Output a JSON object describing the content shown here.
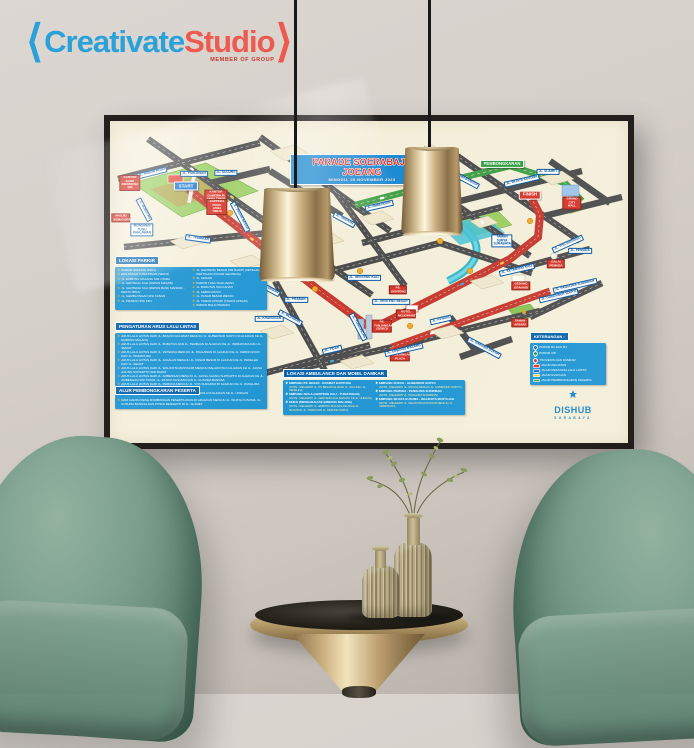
{
  "brand": {
    "bracket_left": "⟨",
    "name_blue": "Creativate",
    "name_red": "Studio",
    "bracket_right": "⟩",
    "tagline": "MEMBER OF GROUP"
  },
  "poster": {
    "title": "PARADE SOERABAJA JOEANG",
    "subtitle": "MINGGU, 05 NOVEMBER 2023",
    "panels": {
      "parking": {
        "header": "LOKASI PARKIR",
        "col1": [
          "PARKIR GEDUNG SIOLA",
          "EKS PASAR TUNJUNGAN (SEIKO)",
          "JL. EMBONG MALANG SISI UTARA",
          "JL. GENTENG KALI (DEPAN MASJID)",
          "JL. GENTENG KALI (DEPAN BANK MANDIRI - RESTO BINA)",
          "JL. GEMBLONGAN SISI KANAN",
          "JL. PRABAN SISI KIRI"
        ],
        "col2": [
          "JL. GENTENG BESAR SISI BARAT (SETELAH PERTIGAAN PASAR GENTENG)",
          "JL. KENARI",
          "PARKIR TUGU PAHLAWAN",
          "JL. BUBUTAN SISI KANAN",
          "JL. KEBON ROJO",
          "JL. PASAR BESAR WETAN",
          "JL. TAMAN APSARI (TAMAN APSARI)",
          "PARKIR BALAI PEMUDA"
        ]
      },
      "traffic": {
        "header": "PENGATURAN ARUS LALU LINTAS",
        "items": [
          "ARUS LALU LINTAS DARI JL. BASUKI RACHMAT MENUJU JL. GUBERNUR SURYO DI ALIHKAN KE JL. EMBONG MALANG",
          "ARUS LALU LINTAS DARI JL. BUBUTAN DAN JL. TEMBAAN DI ALIHKAN KE JL. INDRAPURA DAN JL. SEMUT",
          "ARUS LALU LINTAS DARI JL. VETERAN MENUJU JL. PAHLAWAN DI ALIHKAN KE JL. KEBON ROJO DAN JL. INDRAPURA",
          "ARUS LALU LINTAS DARI JL. JAGALAN MENUJU JL. PASAR BESAR DI ALIHKAN KE JL. PENELEH DAN JL. SEMUT",
          "ARUS LALU LINTAS DARI JL. WALIKOTA MUSTAJAB MENUJU BALAIKOTA DI ALIHKAN KE JL. JAKSA AGUNG SUPRAPTO SISI BARAT",
          "ARUS LALU LINTAS DARI JL. AMBENGAN MENUJU JL. JAKSA AGUNG SUPRAPTO DI ALIHKAN KE JL. AMBENGAN SISI TIMUR, JL. WIJAYA KUSUMA DAN JL. KUSUMA BANGSA",
          "ARUS LALU LINTAS DARI JL. PEMUDA MENUJU JL. YOS SUDARSO DI ALIHKAN KE JL. PANGLIMA SUDIRMAN",
          "ARUS LALU LINTAS DARI JL. GENTENG KALI MENUJU SIOLA DI ALIHKAN KE JL. UNDAAN"
        ]
      },
      "unloading": {
        "header": "ALUR PEMBONGKARAN PESERTA",
        "items": [
          "DARI GARIS FINISH ROMBONGAN PESERTA AKAN DI ARAHKAN MENUJU JL. WIJAYA KUSUMA, JL. KUSUMA BANGSA DAN POSISI BERHENTI DI JL. SLAMET"
        ]
      },
      "ambulance": {
        "header": "LOKASI AMBULANCE DAN MOBIL DAMKAR",
        "col1": [
          {
            "name": "SIMPANG PS. BESAR - KRAMAT GANTUNG",
            "route": "(RUTE : MELEWATI JL. PS BESAR KE ARAH JL. SULUNG / JL. PENELEH)"
          },
          {
            "name": "SIMPANG SIOLA (GENTENG KALI - TUNJUNGAN)",
            "route": "(RUTE : MELEWATI JL. GENTENG KALI MENUJU KE JL. UNDAAN)"
          },
          {
            "name": "SEIKO (MENGARAH KE EMBONG MALANG)",
            "route": "(RUTE : MELEWATI JL. EMBONG MALANG KE ARAH JL. BLAURAN, JL. TIDAR DAN JL. KEDUNG DORO)"
          }
        ],
        "col2": [
          {
            "name": "SIMPANG DUKUH - GUBERNUR SURYO",
            "route": "(RUTE : MELEWATI JL. DUKUH MENUJU JL. GUBERNUR SURYO)"
          },
          {
            "name": "SIMPANG PEMUDA - PANGLIMA SUDIRMAN",
            "route": "(RUTE : MELEWATI JL. PANGLIMA SUDIRMAN)"
          },
          {
            "name": "SIMPANG WIJAYA KUSUMA - WALIKOTA MUSTAJAB",
            "route": "(RUTE : MELEWATI JL. WALIKOTA MUSTAJAB MENUJU JL. AMBENGAN)"
          }
        ]
      },
      "legend": {
        "header": "KETERANGAN :",
        "items": [
          {
            "icon": "pin-blue",
            "label": "PARKIR R2 DAN R4"
          },
          {
            "icon": "pin-green",
            "label": "PARKIR VIP"
          },
          {
            "icon": "pin-red",
            "label": "TIM MEDIS DAN DAMKAR"
          },
          {
            "icon": "line-red",
            "label": "JALUR KEGIATAN"
          },
          {
            "icon": "line-blue",
            "label": "JALUR REKAYASA LALU LINTAS"
          },
          {
            "icon": "line-yellow",
            "label": "JALUR EVAKUASI"
          },
          {
            "icon": "line-green",
            "label": "JALUR PEMBONGKARAN PESERTA"
          }
        ]
      },
      "agency": {
        "name": "DISHUB",
        "city": "SURABAYA"
      }
    },
    "map_labels": {
      "start": "START",
      "finish": "FINISH",
      "pembongkaran": "PEMBONGKARAN",
      "bank_indonesia": "KANTOR BANK INDONESIA (BI)",
      "kantor_gubernur": "KANTOR GUBERNUR JAWA TIMUR",
      "bappeda": "BAPPEDA PROV. JAWA TIMUR",
      "masjid_kemayoran": "MASJID KEMAYORAN",
      "monumen": "MONUMEN TUGU PAHLAWAN",
      "gedung_siola": "GEDUNG SIOLA",
      "ps_genteng": "PS. GENTENG",
      "hotel_mojopahit": "HOTEL MOJOPAHIT",
      "gedung_grahadi": "GEDUNG GRAHADI",
      "balai_pemuda": "BALAI PEMUDA",
      "grand_city": "GRAND CITY MALL",
      "tunjungan_plaza": "TUNJUNGAN PLAZA",
      "ps_tunjungan": "PS. TUNJUNGAN (SEIKO)",
      "taman_apsari": "TAMAN APSARI",
      "taman_surya": "TAMAN SURYA SURABAYA",
      "jl_kebon_rojo": "JL. KEBON ROJO",
      "jl_pahlawan": "JL. PAHLAWAN",
      "jl_sulung": "JL. SULUNG",
      "jl_bubutan": "JL. BUBUTAN",
      "jl_tembaan": "JL. TEMBAAN",
      "jl_pasar_besar": "JL. PASAR BESAR",
      "jl_gemblongan": "JL. GEMBLONGAN",
      "jl_kranggan": "JL. KRANGGAN",
      "jl_praban": "JL. PRABAN",
      "jl_blauran": "JL. BLAURAN",
      "jl_tunjungan": "JL. TUNJUNGAN",
      "jl_genteng_kali": "JL. GENTENG KALI",
      "jl_genteng_besar": "JL. GENTENG BESAR",
      "jl_embong_malang": "JL. EMBONG MALANG",
      "jl_tidar": "JL. TIDAR",
      "jl_kenari": "JL. KENARI",
      "jl_undaan": "JL. UNDAAN",
      "jl_ambengan": "JL. AMBENGAN",
      "jl_wijaya_kusuma": "JL. WIJAYA KUSUMA",
      "jl_kusuma_bangsa": "JL. KUSUMA BANGSA",
      "jl_slamet": "JL. SLAMET",
      "jl_ketabang_kali": "JL. KETABANG KALI",
      "jl_simpang_dukuh": "JL. SIMPANG DUKUH",
      "jl_yos_sudarso": "JL. YOS SUDARSO",
      "jl_pemuda": "JL. PEMUDA",
      "jl_panglima_sudirman": "JL. PANGLIMA SUDIRMAN",
      "jl_gubernur_suryo": "JL. GUBERNUR SURYO"
    }
  },
  "colors": {
    "accent_blue": "#2196d3",
    "accent_red": "#d7372b",
    "accent_green": "#2f9e3f",
    "poster_cream": "#f4efda",
    "lamp_gold": "#cdb282",
    "chair_green": "#7b9e8c"
  }
}
